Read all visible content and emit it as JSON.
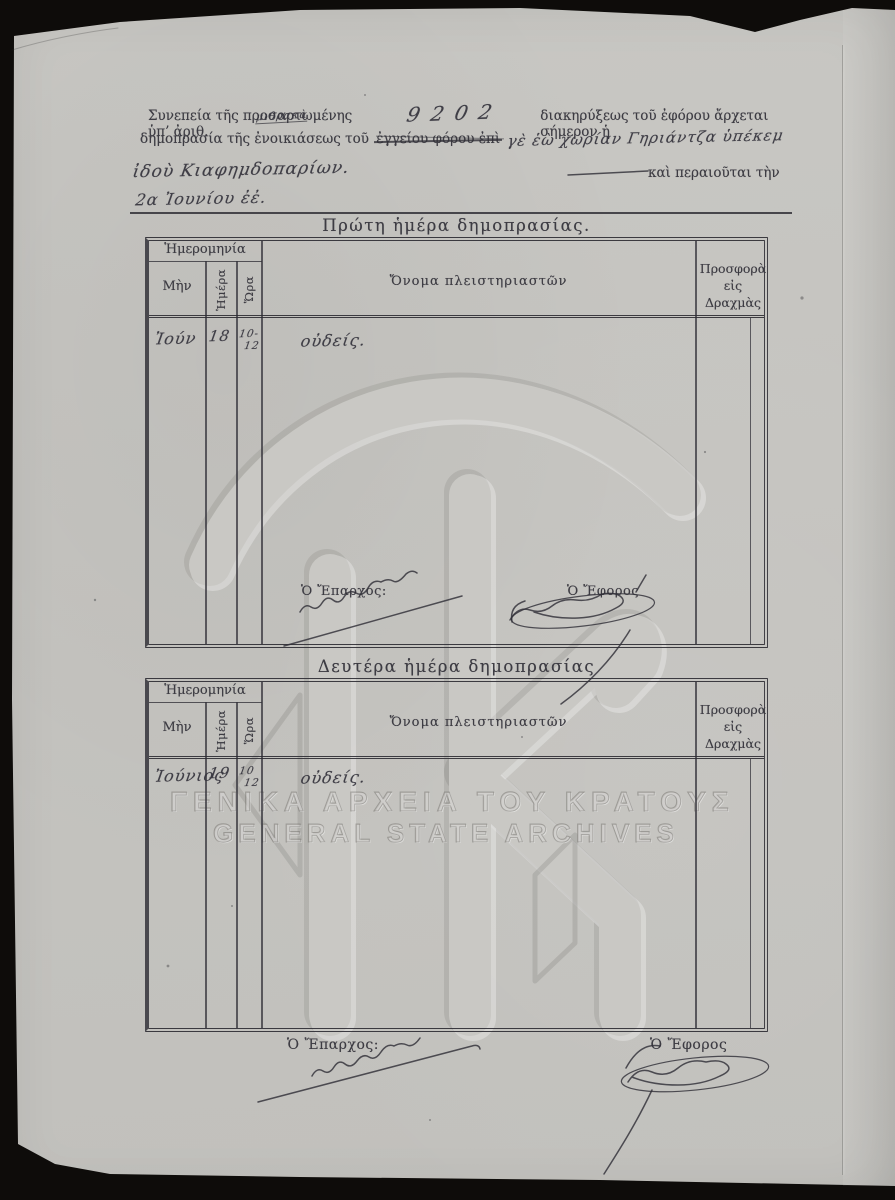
{
  "watermarks": {
    "monogram": "ΓΑΚ",
    "line1": "ΓΕΝΙΚΑ ΑΡΧΕΙΑ ΤΟΥ ΚΡΑΤΟΥΣ",
    "line2": "GENERAL STATE ARCHIVES"
  },
  "preamble": {
    "line1_printed_start": "Συνεπεία τῆς προσαρτωμένης ὑπ’ ἀριθ.",
    "line1_handwritten_number": "9202",
    "line1_printed_end": "διακηρύξεως τοῦ ἐφόρου ἄρχεται σήμερον ἡ",
    "line2_printed": "δημοπρασία τῆς ἐνοικιάσεως τοῦ",
    "line2_struck_printed": "ἐγγείου φόρου ἐπὶ",
    "line2_handwritten": "γὲ ἑὼ χωρίαν Γηριάντζα ὑπέκεμ",
    "line2_annotation_handwritten": "μιθρακὰ",
    "line3_handwritten": "ἰδοὺ Κιαφημδοπαρίων.",
    "line3_printed": "καὶ περαιοῦται τὴν",
    "line4_handwritten": "2α Ἰουνίου ἐἐ."
  },
  "auction_day1": {
    "title": "Πρώτη ἡμέρα δημοπρασίας.",
    "headers": {
      "date_group": "Ἡμερομηνία",
      "month": "Μὴν",
      "day": "Ἡμέρα",
      "hour": "Ὥρα",
      "bidders": "Ὄνομα πλειστηριαστῶν",
      "offer": "Προσφορὰ εἰς Δραχμὰς"
    },
    "entry": {
      "month": "Ἰούν",
      "day": "18",
      "hour_from": "10-",
      "hour_to": "12",
      "bidder": "οὐδείς."
    },
    "eparch_label": "Ὁ Ἔπαρχος:",
    "ephor_label": "Ὁ Ἔφορος"
  },
  "auction_day2": {
    "title": "Δευτέρα ἡμέρα δημοπρασίας",
    "headers": {
      "date_group": "Ἡμερομηνία",
      "month": "Μὴν",
      "day": "Ἡμέρα",
      "hour": "Ὥρα",
      "bidders": "Ὄνομα πλειστηριαστῶν",
      "offer": "Προσφορὰ εἰς Δραχμὰς"
    },
    "entry": {
      "month": "Ἰούνιος",
      "day": "19",
      "hour_from": "10",
      "hour_to": "12",
      "bidder": "οὐδείς."
    }
  },
  "footer": {
    "eparch_label": "Ὁ Ἔπαρχος:",
    "ephor_label": "Ὁ Ἔφορος"
  }
}
